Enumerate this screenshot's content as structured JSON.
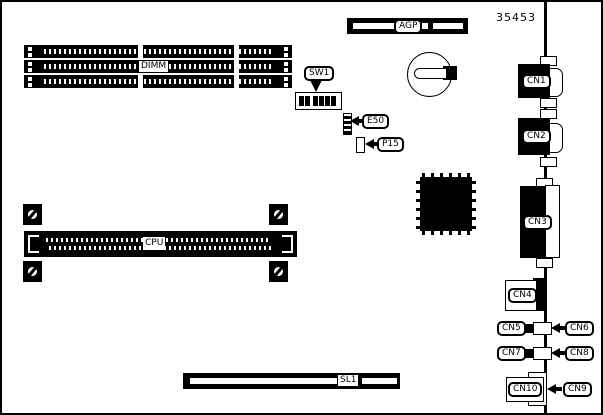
{
  "figure": {
    "part_number": "35453",
    "colors": {
      "line": "#000000",
      "background": "#ffffff"
    }
  },
  "labels": {
    "agp": "AGP",
    "dimm": "DIMM",
    "sw1": "SW1",
    "e50": "E50",
    "p15": "P15",
    "cpu": "CPU",
    "sl1": "SL1",
    "cn1": "CN1",
    "cn2": "CN2",
    "cn3": "CN3",
    "cn4": "CN4",
    "cn5": "CN5",
    "cn6": "CN6",
    "cn7": "CN7",
    "cn8": "CN8",
    "cn9": "CN9",
    "cn10": "CN10"
  }
}
